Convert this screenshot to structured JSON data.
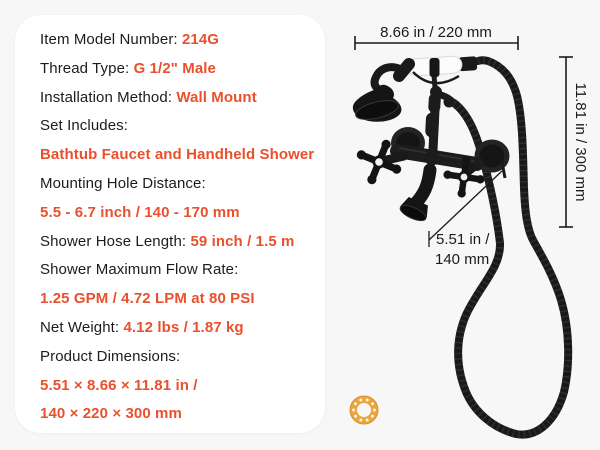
{
  "colors": {
    "page_bg": "#f7f7f8",
    "card_bg": "#ffffff",
    "accent": "#e9502d",
    "text": "#1c1c1e",
    "fixture": "#1a1a1a",
    "ceramic": "#ffffff",
    "gasket_ring": "#e9a640"
  },
  "specs": {
    "lines": [
      {
        "label": "Item Model Number: ",
        "value": "214G"
      },
      {
        "label": "Thread Type: ",
        "value": "G 1/2\" Male"
      },
      {
        "label": "Installation Method: ",
        "value": "Wall Mount"
      },
      {
        "label": "Set Includes:",
        "value": ""
      },
      {
        "label": "",
        "value": "Bathtub Faucet and Handheld Shower"
      },
      {
        "label": "Mounting Hole Distance:",
        "value": ""
      },
      {
        "label": "",
        "value": "5.5 - 6.7 inch / 140 - 170 mm"
      },
      {
        "label": "Shower Hose Length: ",
        "value": "59 inch / 1.5 m"
      },
      {
        "label": "Shower Maximum Flow Rate:",
        "value": ""
      },
      {
        "label": "",
        "value": "1.25 GPM / 4.72 LPM at 80 PSI"
      },
      {
        "label": "Net Weight: ",
        "value": "4.12 lbs / 1.87 kg"
      },
      {
        "label": "Product Dimensions:",
        "value": ""
      },
      {
        "label": "",
        "value": "5.51 × 8.66 × 11.81 in /"
      },
      {
        "label": "",
        "value": "140 × 220 × 300 mm"
      }
    ]
  },
  "diagram": {
    "width_label": "8.66 in / 220 mm",
    "height_label": "11.81 in / 300 mm",
    "spout_reach_label_line1": "5.51 in /",
    "spout_reach_label_line2": "140 mm",
    "subject": "black wall-mount bathtub faucet with handheld shower, coiled hose and gasket ring"
  }
}
